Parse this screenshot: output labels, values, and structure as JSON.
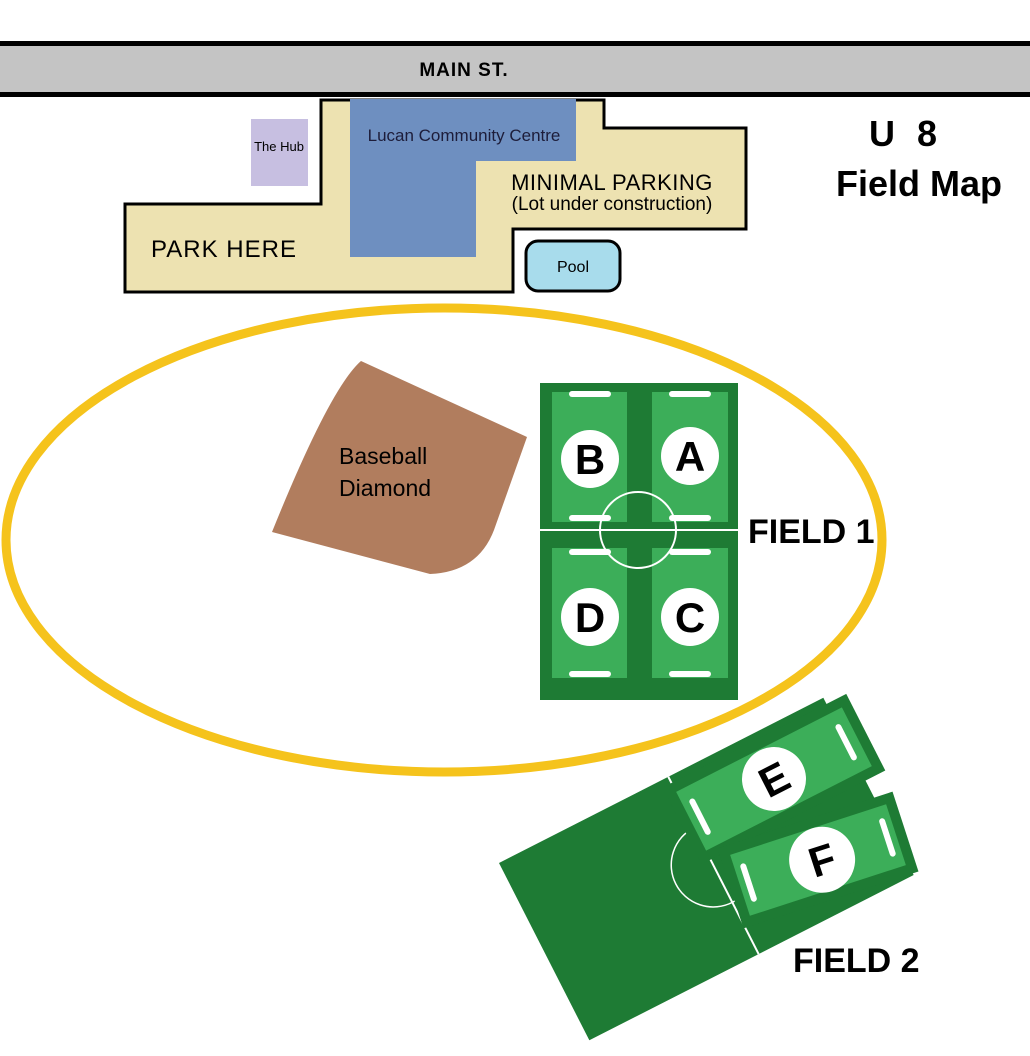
{
  "header": {
    "map_title_line1": "U 8",
    "map_title_line2": "Field Map"
  },
  "road": {
    "name": "MAIN ST."
  },
  "facilities": {
    "community_centre": "Lucan Community Centre",
    "hub": "The Hub",
    "pool": "Pool",
    "baseball_line1": "Baseball",
    "baseball_line2": "Diamond"
  },
  "parking": {
    "park_here": "PARK HERE",
    "minimal": "MINIMAL PARKING",
    "minimal_note": "(Lot under construction)"
  },
  "fields": {
    "field1": {
      "label": "FIELD 1",
      "zone_a": "A",
      "zone_b": "B",
      "zone_c": "C",
      "zone_d": "D"
    },
    "field2": {
      "label": "FIELD 2",
      "zone_e": "E",
      "zone_f": "F"
    }
  },
  "colors": {
    "road_gray": "#C4C4C4",
    "road_edge_black": "#000000",
    "parking_tan": "#EDE2B1",
    "building_blue": "#6E8FC0",
    "hub_purple": "#C7BFE1",
    "pool_blue": "#A8DCEC",
    "track_yellow": "#F5C31C",
    "field_dark_green": "#1E7B34",
    "field_light_green": "#3CAE59",
    "diamond_brown": "#B17D5E"
  }
}
